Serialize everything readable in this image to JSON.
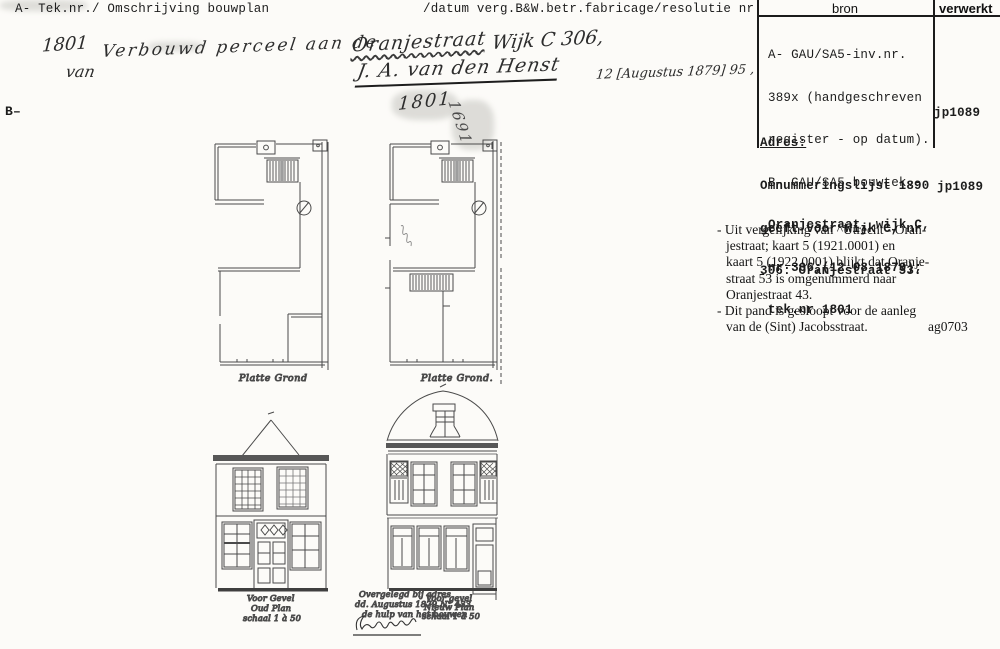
{
  "header": {
    "left": "A- Tek.nr./ Omschrijving bouwplan",
    "middle": "/datum verg.B&W.betr.fabricage/resolutie nr.",
    "col_bron": "bron",
    "col_verwerkt": "verwerkt"
  },
  "bron": {
    "lines": [
      "A- GAU/SA5-inv.nr.",
      "389x (handgeschreven",
      "register - op datum).",
      "B- GAU/SA5-bouwtek.-",
      "Oranjestraat, wijk C,",
      "nr 306;(12-08-1879);",
      "tek.nr 1801"
    ],
    "verwerkt": "jp1089"
  },
  "adres": {
    "label": "Adres:",
    "lines": [
      "Omnummeringslijst 1890",
      "geeft voor Wijk C, nr",
      "306: Oranjestraat 53."
    ],
    "verwerkt": "jp1089"
  },
  "notes": {
    "lines": [
      "- Uit vergelijking van ^Utrecht - Oran-",
      "jestraat; kaart 5 (1921.0001) en",
      "kaart 5 (1922.0001) blijkt dat Oranje-",
      "straat 53 is omgenummerd naar",
      "Oranjestraat 43.",
      "- Dit pand is gesloopt voor de aanleg",
      "van de (Sint) Jacobsstraat."
    ],
    "code": "ag0703"
  },
  "handwritten": {
    "tek_nr": "1801",
    "description": "Verbouwd perceel aan de",
    "street": "Oranjestraat",
    "wijk": "Wijk C 306,",
    "van": "van",
    "owner": "J. A. van den Henst",
    "date": "12 [Augustus 1879] 95 ,",
    "b_label": "B–",
    "drawing_number": "1801",
    "rotated_number": "1691"
  },
  "drawings": {
    "left_plan_label": "Platte Grond",
    "right_plan_label": "Platte Grond.",
    "left_facade": {
      "line1": "Voor Gevel",
      "line2": "Oud Plan",
      "line3": "schaal 1 à 50"
    },
    "right_facade": {
      "line1": "Voor gevel",
      "line2": "Nieuw Plan",
      "line3": "schaal 1 à 50"
    },
    "middle_note": {
      "line1": "Overgelegd bij adres",
      "line2": "dd. Augustus 1879 N° 433",
      "line3": "de hulp van het bouwen"
    }
  }
}
